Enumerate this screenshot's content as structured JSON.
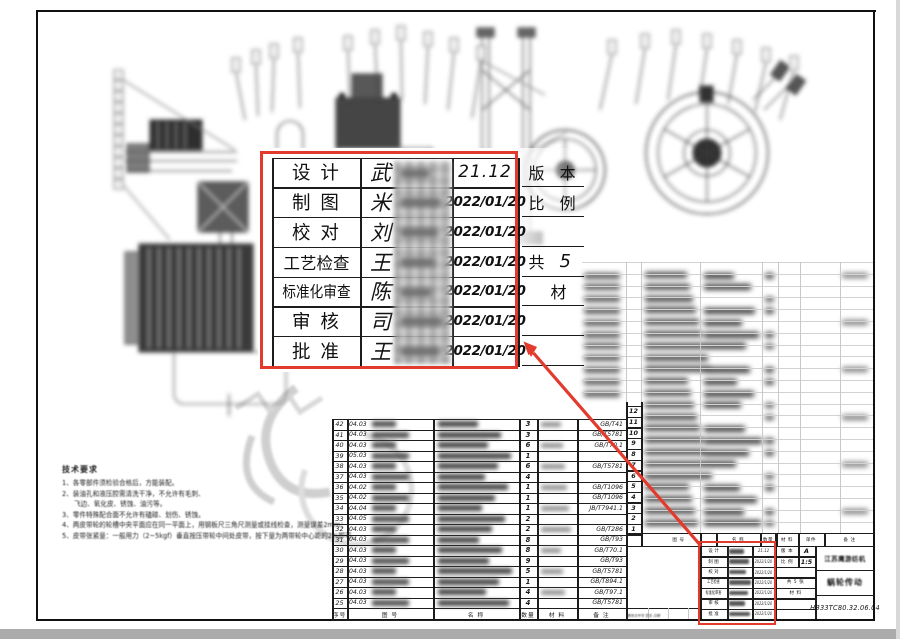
{
  "callout": {
    "rows": [
      {
        "label": "设 计",
        "name": "武",
        "date": "21.12"
      },
      {
        "label": "制 图",
        "name": "米",
        "date": "2022/01/20"
      },
      {
        "label": "校 对",
        "name": "刘",
        "date": "2022/01/20"
      },
      {
        "label": "工艺检查",
        "name": "王",
        "date": "2022/01/20"
      },
      {
        "label": "标准化审查",
        "name": "陈",
        "date": "2022/01/20"
      },
      {
        "label": "审 核",
        "name": "司",
        "date": "2022/01/20"
      },
      {
        "label": "批 准",
        "name": "王",
        "date": "2022/01/20"
      }
    ],
    "side": [
      {
        "l": "版 本",
        "v": ""
      },
      {
        "l": "比 例",
        "v": ""
      },
      {
        "l": "",
        "v": ""
      },
      {
        "l": "共",
        "v": "5"
      },
      {
        "l": "材",
        "v": ""
      },
      {
        "l": "",
        "v": ""
      },
      {
        "l": "",
        "v": ""
      }
    ]
  },
  "bom_mid": {
    "rows": [
      {
        "no": "42",
        "code": "04.03",
        "qty": "3",
        "std": "GB/T41"
      },
      {
        "no": "41",
        "code": "04.03",
        "qty": "3",
        "std": "GB/T5781"
      },
      {
        "no": "40",
        "code": "04.03",
        "qty": "6",
        "std": "GB/T70.1"
      },
      {
        "no": "39",
        "code": "05.03",
        "qty": "1",
        "std": ""
      },
      {
        "no": "38",
        "code": "04.03",
        "qty": "6",
        "std": "GB/T5781"
      },
      {
        "no": "37",
        "code": "04.03",
        "qty": "4",
        "std": ""
      },
      {
        "no": "36",
        "code": "04.02",
        "qty": "1",
        "std": "GB/T1096"
      },
      {
        "no": "35",
        "code": "04.02",
        "qty": "1",
        "std": "GB/T1096"
      },
      {
        "no": "34",
        "code": "04.04",
        "qty": "1",
        "std": "JB/T7941.1"
      },
      {
        "no": "33",
        "code": "04.05",
        "qty": "2",
        "std": ""
      },
      {
        "no": "32",
        "code": "04.03",
        "qty": "2",
        "std": "GB/T286"
      },
      {
        "no": "31",
        "code": "04.03",
        "qty": "8",
        "std": "GB/T93"
      },
      {
        "no": "30",
        "code": "04.03",
        "qty": "8",
        "std": "GB/T70.1"
      },
      {
        "no": "29",
        "code": "04.03",
        "qty": "9",
        "std": "GB/T93"
      },
      {
        "no": "28",
        "code": "04.03",
        "qty": "5",
        "std": "GB/T5781"
      },
      {
        "no": "27",
        "code": "04.03",
        "qty": "1",
        "std": "GB/T894.1"
      },
      {
        "no": "26",
        "code": "04.03",
        "qty": "4",
        "std": "GB/T97.1"
      },
      {
        "no": "25",
        "code": "04.03",
        "qty": "4",
        "std": "GB/T5781"
      }
    ],
    "footer": [
      "序号",
      "图 号",
      "名 称",
      "数量",
      "材 料",
      "备 注"
    ]
  },
  "bom_right": {
    "serials": [
      "12",
      "11",
      "10",
      "9",
      "8",
      "7",
      "6",
      "5",
      "4",
      "3",
      "2",
      "1"
    ],
    "header": [
      "图 号",
      "名 称",
      "数量",
      "材 料",
      "单件",
      "备 注"
    ]
  },
  "titleblock": {
    "mid_rows": [
      {
        "l": "版 本",
        "v": "A"
      },
      {
        "l": "比 例",
        "v": "1:5"
      },
      {
        "l": "",
        "v": ""
      },
      {
        "l": "共 5 张",
        "v": ""
      },
      {
        "l": "材 料",
        "v": ""
      },
      {
        "l": "",
        "v": ""
      },
      {
        "l": "",
        "v": ""
      }
    ],
    "date_first": "21.12",
    "date_rest": "2022/1/20",
    "company": "江苏鹰游纺机",
    "title": "蜗轮传动",
    "drawing_no": "HB33TC80.32.06.04",
    "revision_note": "更改文件号  签名  日期"
  },
  "notes": {
    "title": "技术要求",
    "items": [
      {
        "t": "1、各零部件须检验合格后，方能装配。",
        "i": 0
      },
      {
        "t": "2、装油孔和液压腔需清洗干净，不允许有毛刺、",
        "i": 0
      },
      {
        "t": "飞边、氧化皮、锈蚀、油污等。",
        "i": 1
      },
      {
        "t": "3、零件特殊配合面不允许有磕碰、划伤、锈蚀。",
        "i": 0
      },
      {
        "t": "4、两皮带轮的轮槽中央平面应在同一平面上，用钢板尺三角尺测量或挂线检查，测量误差2mm；",
        "i": 0
      },
      {
        "t": "5、皮带张紧量：一般用力（2~5kgf）垂直按压带轮中间处皮带，按下量为两带轮中心距的2%即可。",
        "i": 0
      }
    ]
  },
  "colors": {
    "red": "#e23a2c",
    "line": "#1a1a1a",
    "bottom_band": "#ababab"
  }
}
